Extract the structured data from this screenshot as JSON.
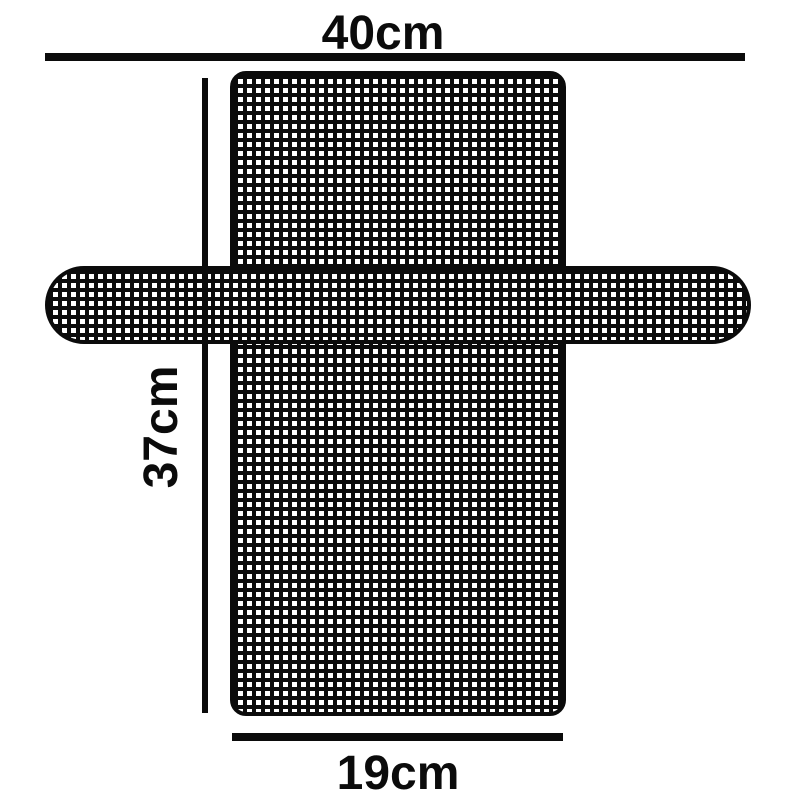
{
  "diagram": {
    "type": "product-dimension-diagram",
    "subject": "cross-shaped mesh grid panel with side straps",
    "labels": {
      "top_width": "40cm",
      "side_height": "37cm",
      "bottom_width": "19cm"
    },
    "measurements": {
      "top_width_cm": 40,
      "side_height_cm": 37,
      "bottom_width_cm": 19,
      "unit": "cm"
    },
    "colors": {
      "ink": "#0b0b0b",
      "background": "#ffffff"
    }
  }
}
